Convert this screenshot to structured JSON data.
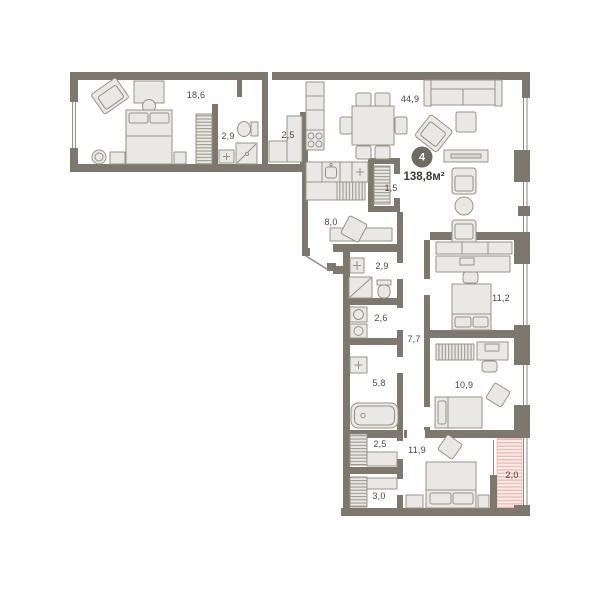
{
  "summary": {
    "rooms_count": "4",
    "total_area": "138,8м²"
  },
  "rooms": [
    {
      "name": "bedroom-master",
      "area": "18,6"
    },
    {
      "name": "bathroom-top",
      "area": "2,9"
    },
    {
      "name": "wardrobe-top",
      "area": "2,5"
    },
    {
      "name": "kitchen-living",
      "area": "44,9"
    },
    {
      "name": "hall-wardrobe",
      "area": "1,5"
    },
    {
      "name": "hallway",
      "area": "8,0"
    },
    {
      "name": "bathroom-middle",
      "area": "2,9"
    },
    {
      "name": "laundry",
      "area": "2,6"
    },
    {
      "name": "corridor",
      "area": "7,7"
    },
    {
      "name": "bathroom-lower",
      "area": "5,8"
    },
    {
      "name": "bedroom-2",
      "area": "11,2"
    },
    {
      "name": "bedroom-3",
      "area": "10,9"
    },
    {
      "name": "wardrobe-lower-1",
      "area": "2,5"
    },
    {
      "name": "bedroom-4",
      "area": "11,9"
    },
    {
      "name": "wardrobe-lower-2",
      "area": "3,0"
    },
    {
      "name": "balcony",
      "area": "2,0"
    }
  ],
  "colors": {
    "wall": "#7d776e",
    "furniture_fill": "#e9e8e4",
    "furniture_stroke": "#98938a",
    "balcony_hatch": "#f3b6af",
    "label_text": "#4b473f",
    "badge_bg": "#6f6a62"
  }
}
